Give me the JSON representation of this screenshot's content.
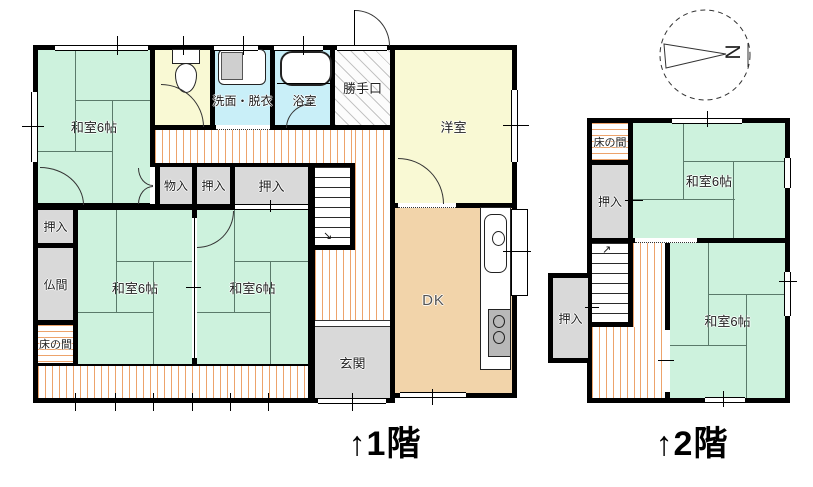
{
  "compass": {
    "letter": "N"
  },
  "colors": {
    "tatami": "#cdf2dd",
    "wet_room": "#c9eff8",
    "western_room": "#f9f9d4",
    "dining_kitchen": "#f2d4aa",
    "closet": "#d9d9d9",
    "floor_stripe": "#eda36b",
    "wall": "#000000"
  },
  "floor1": {
    "caption": "↑1階",
    "rooms": {
      "washitsu_nw": "和室6帖",
      "senmen": "洗面・脱衣",
      "yokushitsu": "浴室",
      "katteguchi": "勝手口",
      "yoshitsu": "洋室",
      "monoire": "物入",
      "oshiire_a": "押入",
      "oshiire_b": "押入",
      "oshiire_w": "押入",
      "butsuma": "仏間",
      "tokonoma": "床の間",
      "washitsu_sw": "和室6帖",
      "washitsu_se": "和室6帖",
      "dk": "DK",
      "genkan": "玄関"
    }
  },
  "floor2": {
    "caption": "↑2階",
    "rooms": {
      "tokonoma": "床の間",
      "oshiire_n": "押入",
      "washitsu_n": "和室6帖",
      "oshiire_s": "押入",
      "washitsu_s": "和室6帖"
    }
  }
}
